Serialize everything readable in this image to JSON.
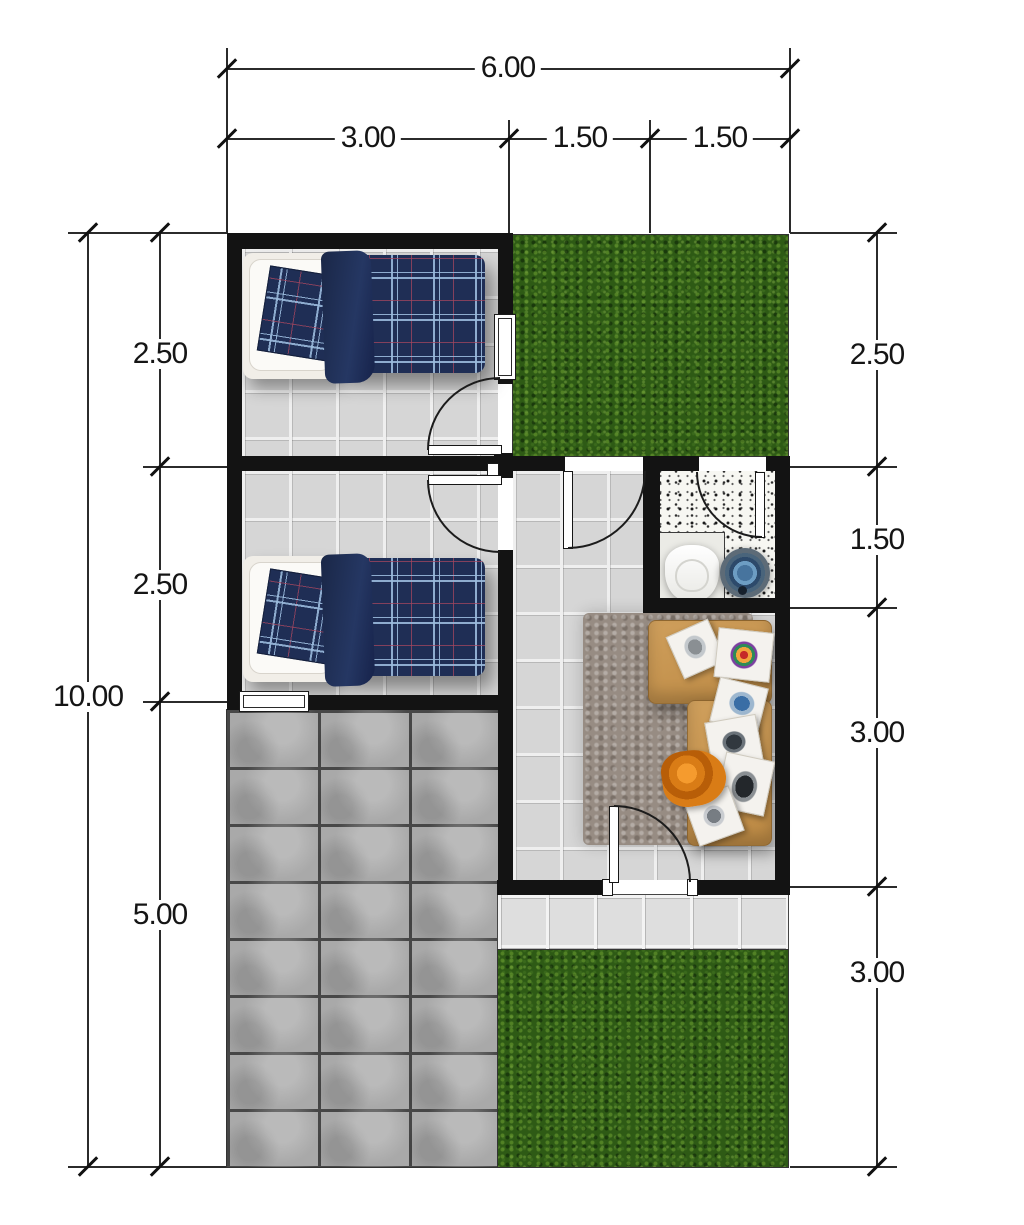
{
  "title": "house-floor-plan",
  "dimensions": {
    "top": {
      "total": "6.00",
      "segments": [
        "3.00",
        "1.50",
        "1.50"
      ]
    },
    "left": {
      "total": "10.00",
      "segments": [
        "2.50",
        "2.50",
        "5.00"
      ]
    },
    "right": {
      "segments": [
        "2.50",
        "1.50",
        "3.00",
        "3.00"
      ]
    }
  },
  "colors": {
    "wall": "#131313",
    "tile_floor": "#d6d6d6",
    "grass": "#2e5a15",
    "concrete_paving": "#a9a9a9",
    "bathroom_terrazzo": "#f7f7f2",
    "sofa": "#c99a55",
    "rug": "#978c83",
    "bed_plaid": "#1f2e55",
    "water_bucket": "#47749e",
    "dimension_line": "#2b2b2b"
  }
}
